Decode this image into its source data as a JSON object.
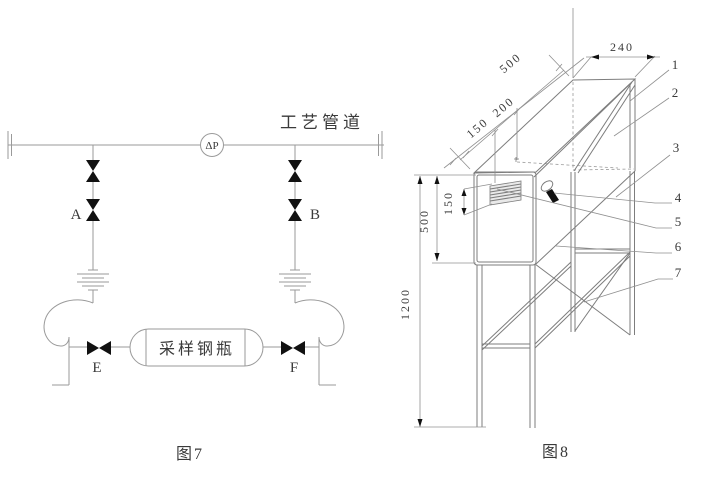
{
  "figure7": {
    "caption": "图7",
    "pipeline_label": "工艺管道",
    "instrument_tag": "ΔP",
    "valves": {
      "a": "A",
      "b": "B",
      "e": "E",
      "f": "F"
    },
    "cylinder_label": "采样钢瓶"
  },
  "figure8": {
    "caption": "图8",
    "dims": {
      "width_240": "240",
      "depth_500": "500",
      "seg_150": "150",
      "seg_200": "200",
      "height_500": "500",
      "louver_150": "150",
      "stand_1200": "1200"
    },
    "callouts": [
      "1",
      "2",
      "3",
      "4",
      "5",
      "6",
      "7"
    ]
  },
  "colors": {
    "pipe_line": "#9a9a9a",
    "frame_line": "#7d7d7d",
    "dimension_line": "#909090",
    "text": "#3a3a3a",
    "valve_fill": "#111111",
    "background": "#ffffff"
  }
}
